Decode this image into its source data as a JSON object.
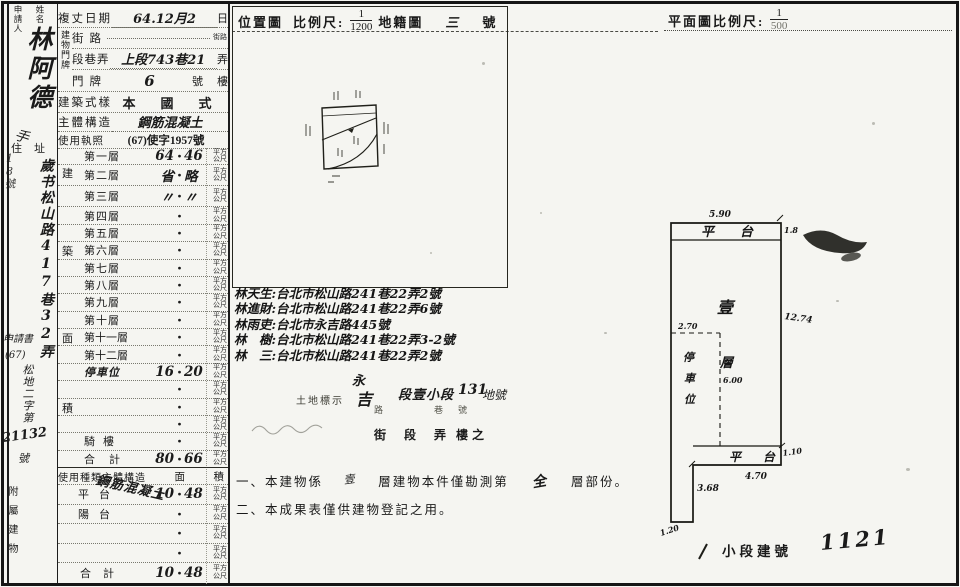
{
  "page": {
    "paper": "#f5f5f1",
    "ink": "#1a1a1a"
  },
  "left_margin": {
    "col_label_1": "申請人",
    "col_label_2": "姓名",
    "name_hw": "林阿德",
    "sig": "手",
    "addr_label": "住址",
    "house_side": "18號",
    "addr_hw": "歲书松山路417巷32弄",
    "doc_1": "申請書",
    "doc_2": "(67)",
    "doc_3": "松地二字第",
    "doc_no": "21132",
    "doc_unit": "號",
    "annex_label": "附屬建物"
  },
  "form": {
    "date": {
      "label": "複丈日期",
      "value": "64.12月2",
      "unit": "日"
    },
    "door": {
      "group_label": "建物門牌",
      "street_label": "街路",
      "street_value": "",
      "street_unit": "街路",
      "lane_label": "段巷弄",
      "lane_value": "上段743巷21",
      "lane_unit": "弄",
      "number_label": "門牌",
      "number_value": "6",
      "number_suffix": "號",
      "number_unit": "樓"
    },
    "style_label": "建築式樣",
    "style_value": "本　國　式",
    "structure_label": "主體構造",
    "structure_value": "鋼筋混凝土",
    "license_label": "使用執照",
    "license_value": "(67)使字1957號",
    "floors": {
      "side_chars": [
        "建",
        "築",
        "面",
        "積"
      ],
      "dot": "・",
      "unit": "平方公尺",
      "rows": [
        {
          "label": "第一層",
          "int": "64",
          "dec": "46"
        },
        {
          "label": "第二層",
          "int": "省",
          "dec": "略"
        },
        {
          "label": "第三層",
          "int": "〃",
          "dec": "〃"
        },
        {
          "label": "第四層",
          "int": "",
          "dec": ""
        },
        {
          "label": "第五層",
          "int": "",
          "dec": ""
        },
        {
          "label": "第六層",
          "int": "",
          "dec": ""
        },
        {
          "label": "第七層",
          "int": "",
          "dec": ""
        },
        {
          "label": "第八層",
          "int": "",
          "dec": ""
        },
        {
          "label": "第九層",
          "int": "",
          "dec": ""
        },
        {
          "label": "第十層",
          "int": "",
          "dec": ""
        },
        {
          "label": "第十一層",
          "int": "",
          "dec": ""
        },
        {
          "label": "第十二層",
          "int": "",
          "dec": ""
        },
        {
          "label": "停車位",
          "int": "16",
          "dec": "20"
        },
        {
          "label": "",
          "int": "",
          "dec": ""
        },
        {
          "label": "",
          "int": "",
          "dec": ""
        },
        {
          "label": "",
          "int": "",
          "dec": ""
        },
        {
          "label": "騎樓",
          "int": "",
          "dec": ""
        },
        {
          "label": "合計",
          "int": "80",
          "dec": "66"
        }
      ]
    }
  },
  "annex_table": {
    "header_left": "使用種類主體構造",
    "header_mid": "面",
    "header_right": "積",
    "dot": "・",
    "unit": "平方公尺",
    "rows": [
      {
        "label": "平台",
        "structure": "鋼筋混凝土",
        "int": "10",
        "dec": "48"
      },
      {
        "label": "陽台",
        "structure": "",
        "int": "",
        "dec": ""
      },
      {
        "label": "",
        "structure": "",
        "int": "",
        "dec": ""
      },
      {
        "label": "",
        "structure": "",
        "int": "",
        "dec": ""
      },
      {
        "label": "合計",
        "structure": "",
        "int": "10",
        "dec": "48"
      }
    ]
  },
  "location_header": {
    "title": "位置圖",
    "scale_label": "比例尺:",
    "num": "1",
    "den": "1200",
    "map_label": "地籍圖",
    "sheet": "三",
    "sheet_unit": "號"
  },
  "plan_header": {
    "label": "平面圖比例尺:",
    "num": "1",
    "den": "500"
  },
  "owners": [
    {
      "name": "林天生",
      "addr": "台北市松山路241巷22弄2號"
    },
    {
      "name": "林進財",
      "addr": "台北市松山路241巷22弄6號"
    },
    {
      "name": "林雨吏",
      "addr": "台北市永吉路445號"
    },
    {
      "name": "林　樹",
      "addr": "台北市松山路241巷22弄3-2號"
    },
    {
      "name": "林　三",
      "addr": "台北市松山路241巷22弄2號"
    }
  ],
  "land": {
    "hw_top": "永",
    "hw_bottom": "吉",
    "marker": "土地標示",
    "section": "段壹小段",
    "lot": "131",
    "lot_suffix": "地號",
    "t_road_top": "路",
    "t_road_bot": "街",
    "t_duan": "段",
    "t_lane_top": "巷",
    "t_lane_bot": "弄",
    "t_num_top": "號",
    "t_num_bot": "樓之"
  },
  "notes": {
    "n1_a": "一、本建物係",
    "n1_fill1": "壹",
    "n1_b": "層建物本件僅勘測第",
    "n1_fill2": "全",
    "n1_c": "層部份。",
    "n2": "二、本成果表僅供建物登記之用。"
  },
  "plan": {
    "top_width": "5.90",
    "strip_label": "平台",
    "strip_right": "1.8",
    "height_right": "12.74",
    "one": "壹",
    "floor": "層",
    "parking_chars": [
      "停",
      "車",
      "位"
    ],
    "park_w": "2.70",
    "park_h": "6.00",
    "bottom_label": "平台",
    "bottom_w": "4.70",
    "bottom_h": "1.10",
    "left_seg": "3.68",
    "corner": "1.20"
  },
  "footer": {
    "label": "小段建號",
    "number": "1121"
  }
}
